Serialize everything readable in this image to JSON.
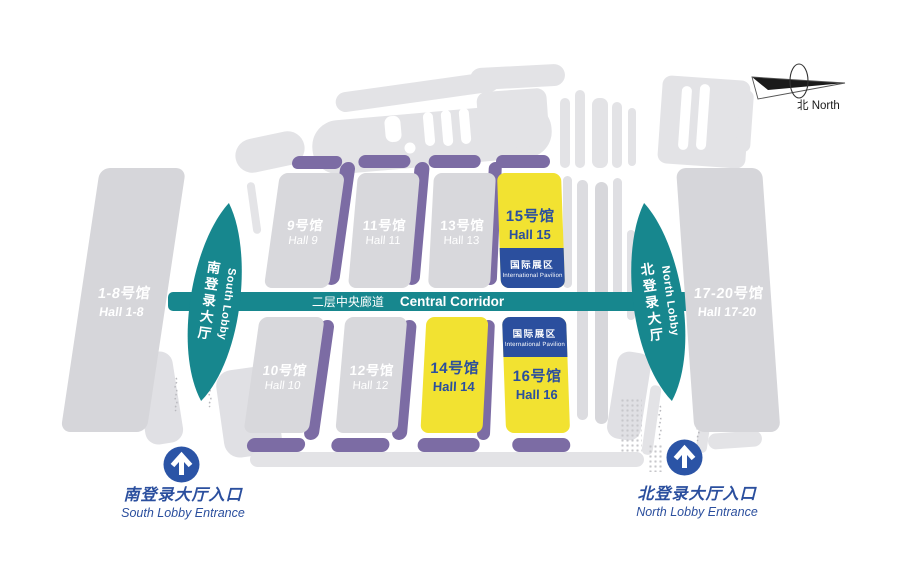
{
  "compass": {
    "label": "北 North"
  },
  "corridor": {
    "zh": "二层中央廊道",
    "en": "Central Corridor"
  },
  "badge": {
    "zh": "国际展区",
    "en": "International Pavilion"
  },
  "wings": {
    "left": {
      "zh": "1-8号馆",
      "en": "Hall 1-8"
    },
    "right": {
      "zh": "17-20号馆",
      "en": "Hall 17-20"
    }
  },
  "lobbies": {
    "south": {
      "zh": "南登录大厅",
      "en": "South Lobby"
    },
    "north": {
      "zh": "北登录大厅",
      "en": "North Lobby"
    }
  },
  "halls": {
    "h9": {
      "zh": "9号馆",
      "en": "Hall 9",
      "highlighted": false
    },
    "h10": {
      "zh": "10号馆",
      "en": "Hall 10",
      "highlighted": false
    },
    "h11": {
      "zh": "11号馆",
      "en": "Hall 11",
      "highlighted": false
    },
    "h12": {
      "zh": "12号馆",
      "en": "Hall 12",
      "highlighted": false
    },
    "h13": {
      "zh": "13号馆",
      "en": "Hall 13",
      "highlighted": false
    },
    "h14": {
      "zh": "14号馆",
      "en": "Hall 14",
      "highlighted": true
    },
    "h15": {
      "zh": "15号馆",
      "en": "Hall 15",
      "highlighted": true,
      "international_pavilion": true
    },
    "h16": {
      "zh": "16号馆",
      "en": "Hall 16",
      "highlighted": true,
      "international_pavilion": true
    }
  },
  "entrances": {
    "south": {
      "zh": "南登录大厅入口",
      "en": "South Lobby Entrance"
    },
    "north": {
      "zh": "北登录大厅入口",
      "en": "North Lobby Entrance"
    }
  },
  "colors": {
    "teal": "#17878E",
    "yellow": "#F2E231",
    "purple": "#7C6CA4",
    "hall_gray": "#D8D8DC",
    "accent_blue": "#2B4F9E",
    "entrance_blue": "#2B54A6",
    "decor_gray": "#E3E3E6"
  }
}
